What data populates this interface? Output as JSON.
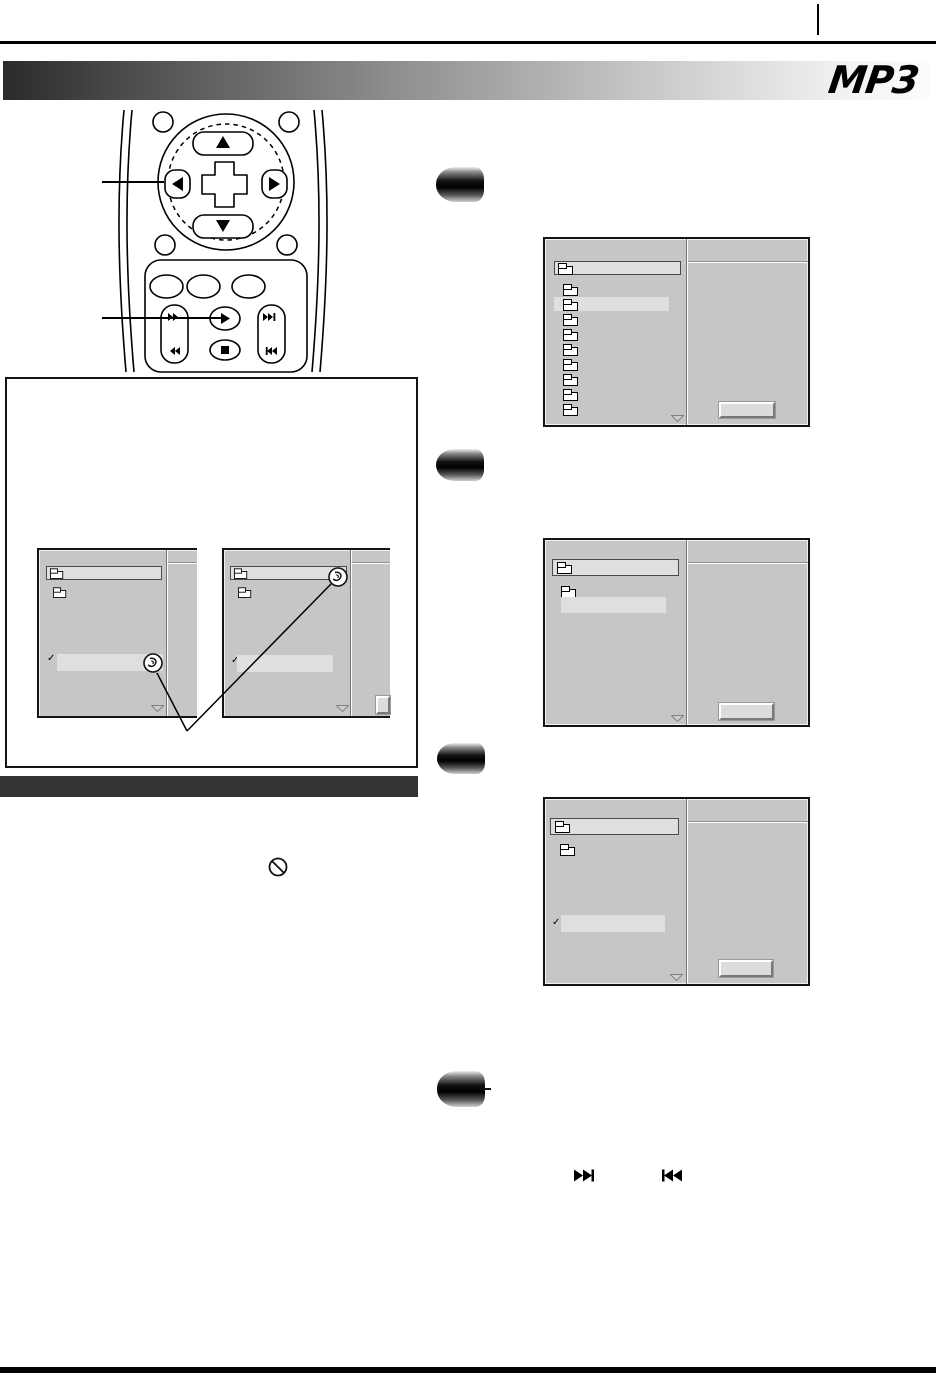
{
  "page": {
    "type": "instruction-manual-page",
    "background": "#ffffff"
  },
  "header": {
    "logo": "MP3",
    "top_rule_color": "#000000",
    "page_tab_marker": true,
    "gradient_bar": {
      "left_color": "#2b2b2b",
      "right_color": "#fbfbfb"
    }
  },
  "palette": {
    "screen_body": "#c6c6c6",
    "screen_row_highlight": "#dfdfdf",
    "screen_border": "#141414",
    "divider_dark": "#757575",
    "divider_light": "#fdfdfd",
    "section_bar": "#333333"
  },
  "remote_figure": {
    "pad_buttons": [
      {
        "icon": "up-arrow"
      },
      {
        "icon": "down-arrow"
      },
      {
        "icon": "left-arrow"
      },
      {
        "icon": "right-arrow"
      },
      {
        "icon": "center-cross"
      }
    ],
    "transport_buttons": [
      {
        "icon": "fast-forward"
      },
      {
        "icon": "rewind"
      },
      {
        "icon": "play"
      },
      {
        "icon": "stop"
      },
      {
        "icon": "skip-next"
      },
      {
        "icon": "skip-previous"
      }
    ],
    "callouts": [
      {
        "target": "left-arrow-button"
      },
      {
        "target": "play-button"
      }
    ]
  },
  "figure_box": {
    "screens": [
      {
        "name": "example-screen-left",
        "rows": [
          {
            "type": "selected-folder-row"
          },
          {
            "type": "folder-row"
          },
          {
            "type": "checked-track-row",
            "marker": "circled-swirl"
          }
        ]
      },
      {
        "name": "example-screen-right",
        "rows": [
          {
            "type": "selected-folder-row",
            "marker": "circled-swirl"
          },
          {
            "type": "folder-row"
          },
          {
            "type": "checked-track-row"
          }
        ]
      }
    ],
    "marker_icon": "circled-swirl"
  },
  "section": {
    "bar_label": "",
    "prohibition_icon": true
  },
  "steps": [
    {
      "screen": {
        "description": "folder-list",
        "top_row": "selected-folder",
        "folder_rows": 9,
        "highlighted_row_index": 2,
        "action_button": true
      }
    },
    {
      "screen": {
        "description": "folder-open",
        "top_row": "selected-folder",
        "rows": [
          "folder",
          "highlighted-track"
        ],
        "action_button": true
      }
    },
    {
      "screen": {
        "description": "track-checked",
        "top_row": "selected-folder",
        "rows": [
          "folder",
          "checked-track"
        ],
        "action_button": true
      }
    },
    {
      "icons": [
        {
          "name": "skip-next"
        },
        {
          "name": "skip-previous"
        }
      ]
    }
  ]
}
